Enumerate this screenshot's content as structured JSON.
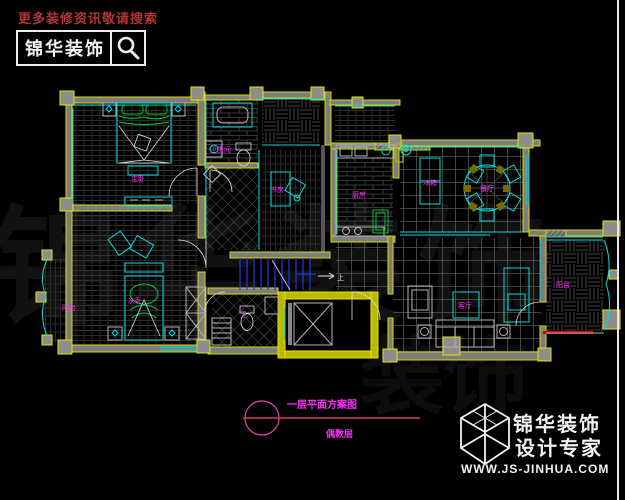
{
  "header": {
    "search_hint": "更多装修资讯敬请搜索",
    "logo_text": "锦华装饰",
    "search_icon": "magnifier-icon"
  },
  "watermark": {
    "text": "锦华装饰",
    "text2": "装饰"
  },
  "plan": {
    "room_labels": [
      {
        "text": "主卧"
      },
      {
        "text": "卫生间"
      },
      {
        "text": "书房"
      },
      {
        "text": "厨房"
      },
      {
        "text": "餐厅"
      },
      {
        "text": "冰箱"
      },
      {
        "text": "次卧"
      },
      {
        "text": "阳台"
      },
      {
        "text": "卫"
      },
      {
        "text": "客厅"
      },
      {
        "text": "阳台"
      }
    ],
    "stair_up_label": "上"
  },
  "annotation": {
    "title": "一层平面方案图",
    "subtitle": "偶数层"
  },
  "footer": {
    "brand_line1": "锦华装饰",
    "brand_line2": "设计专家",
    "website": "WWW.JS-JINHUA.COM"
  },
  "colors": {
    "background": "#000000",
    "wall_yellow": "#d9d900",
    "wall_fill": "#7d7d7d",
    "furniture_cyan": "#00dcdc",
    "bed_green": "#00c838",
    "label_magenta": "#ff2cff",
    "stair_blue": "#2a35e8",
    "threshold_red": "#d40000",
    "annotation_pink": "#e544b8",
    "annotation_line": "#c8445c",
    "header_red": "#b23535",
    "logo_white": "#ededed"
  }
}
